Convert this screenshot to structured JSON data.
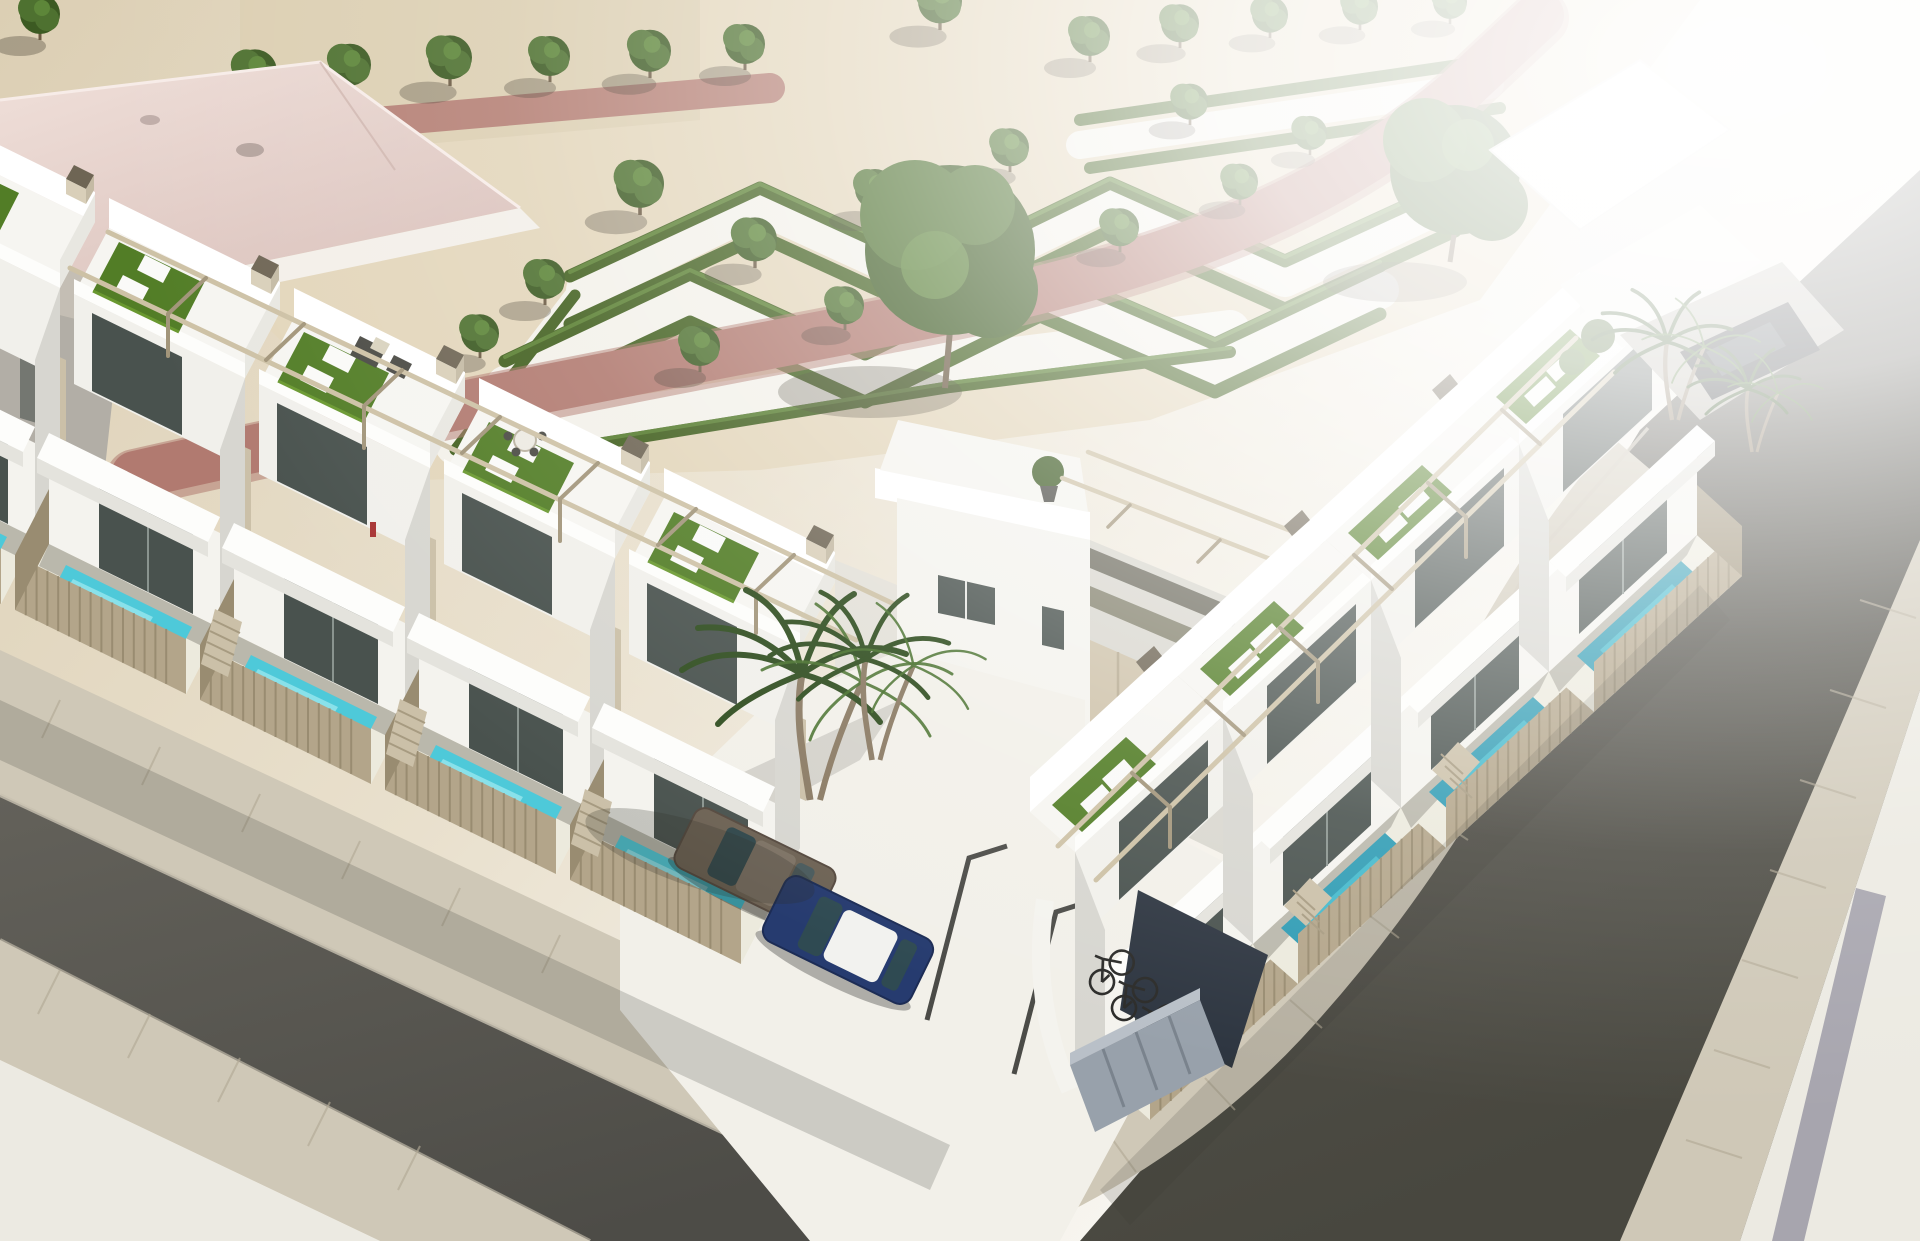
{
  "scene": {
    "type": "architectural-3d-render",
    "view": "aerial corner view",
    "subject": "modern white townhouse complex with rooftop terraces and private pools",
    "setting": "street corner beside a landscaped sand park with geometric hedges",
    "visible_text": "none"
  },
  "palette": {
    "sand": "#e3d6bb",
    "sandDeep": "#d6c7a9",
    "parkPath": "#f3f1ea",
    "hedge": "#42601f",
    "hedgeLight": "#5d8434",
    "treeDark": "#3c5a22",
    "treeMid": "#4e7130",
    "treeLight": "#5d8639",
    "trunk": "#6b5a43",
    "redPath": "#b17a70",
    "redPathLight": "#c08d84",
    "pinkRoof": "#e7d4ce",
    "pinkRoofDeep": "#d9c0ba",
    "road": "#585751",
    "roadDark": "#4d4c47",
    "paver": "#cfc8b7",
    "paverLine": "#b2a995",
    "sidewalkLight": "#eceae2",
    "wall": "#f4f3ee",
    "wall2": "#f1f0eb",
    "wallBright": "#fdfdfb",
    "wallShade": "#d7d6d0",
    "wallDark": "#bdbcb6",
    "glass": "#49524e",
    "glassLight": "#8a948f",
    "fence": "#b3a58a",
    "fenceDark": "#998c71",
    "pergola": "#cdc1a5",
    "pergolaDark": "#a2957a",
    "turf": "#527d26",
    "turfLight": "#69982f",
    "pool": "#4ec9d9",
    "poolLight": "#9ee8ef",
    "poolShade": "#2f9cb4",
    "chimneyCap": "#6e6554",
    "concrete": "#cbc0a8",
    "oliveBand": "#85836f",
    "carBrown": "#6d6254",
    "carBlue": "#263b6f",
    "carBlack": "#23262a",
    "carRoofWhite": "#f2f2ef",
    "bike": "#2b2b29",
    "locker": "#98a1ab",
    "lockerDark": "#7a838d",
    "darkWall": "#2d3540",
    "marking": "#4b4b47",
    "shadow": "rgba(58,55,48,0.28)",
    "glare": "#ffffff"
  },
  "inventory": {
    "left_row_townhouses": 5,
    "right_row_townhouses": 4,
    "rooftop_terraces_with_turf": 9,
    "private_pools": 8,
    "parked_cars": [
      {
        "name": "brown-car",
        "color_key": "carBrown"
      },
      {
        "name": "blue-car-white-roof",
        "color_key": "carBlue"
      },
      {
        "name": "dark-car-right-driveway",
        "color_key": "carBlack"
      }
    ],
    "bicycles": 3,
    "palm_trees": 3,
    "park_trees_approx": 22,
    "hedge_zigzag_rows": 5,
    "streets": 2,
    "parking_space_markings": 3,
    "storage_lockers": 1,
    "garage_doors": 1
  }
}
